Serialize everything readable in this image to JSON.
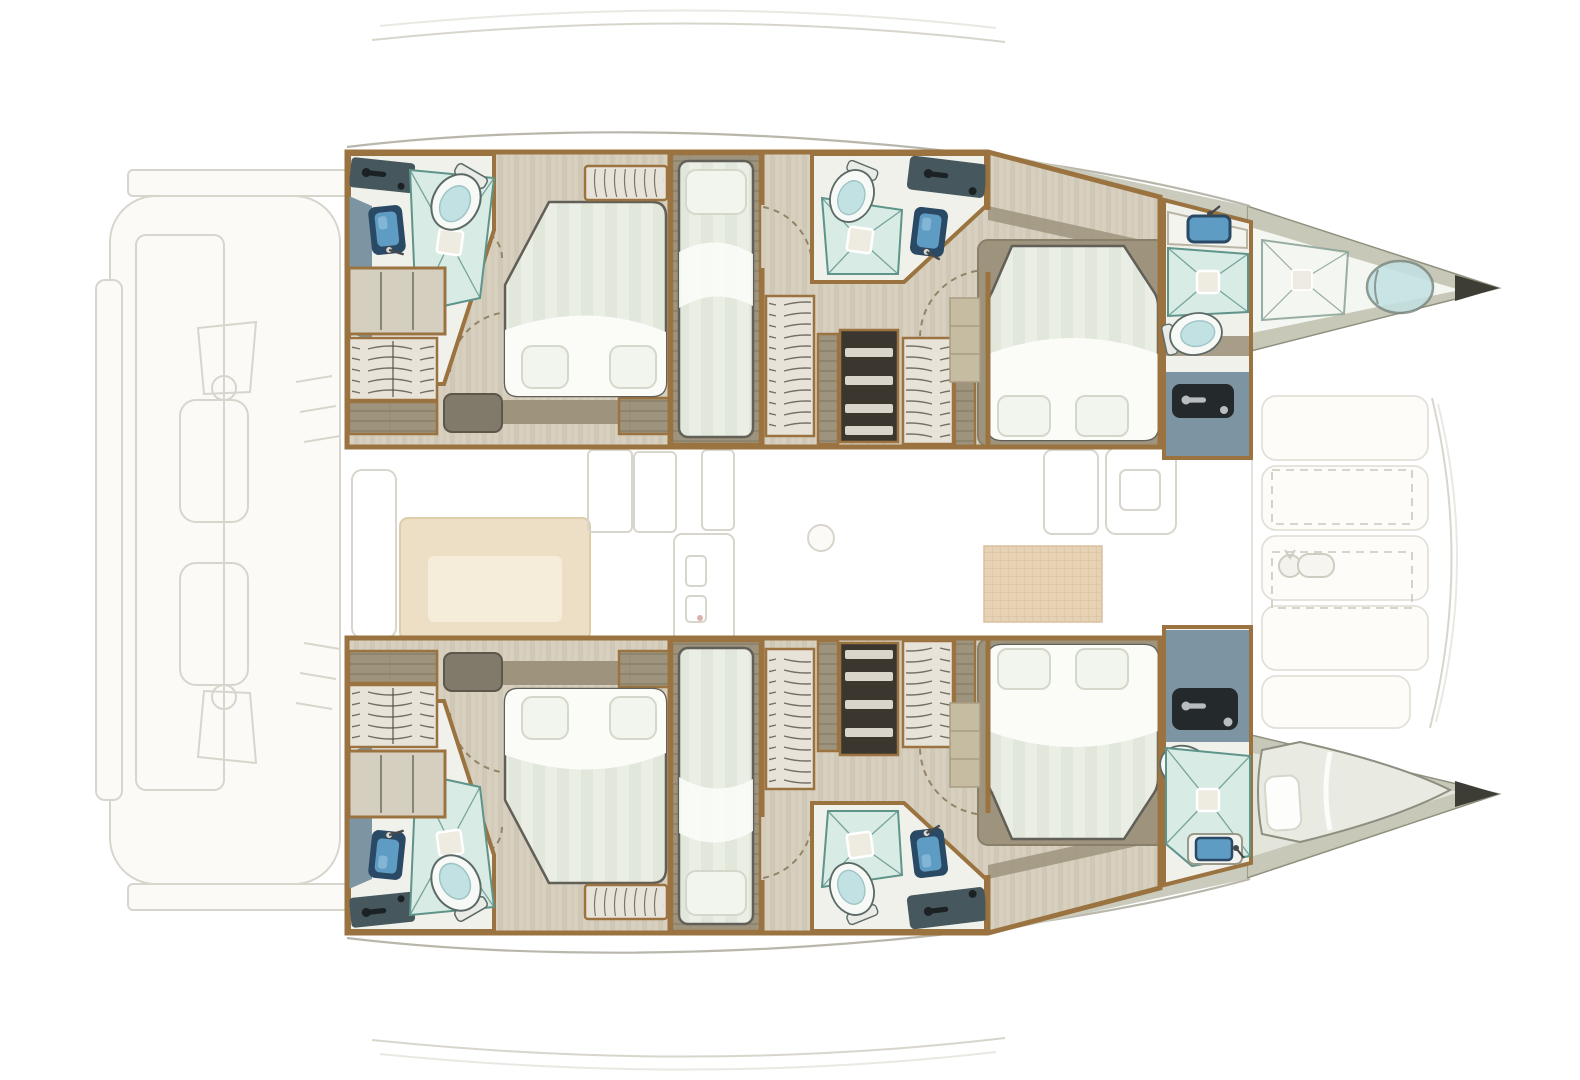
{
  "image": {
    "title": "Catamaran layout floor plan",
    "subject": "Top-down deck plan of a sailing catamaran: five-cabin interior layout, bow to the right, stern to the left; hull accommodations rendered in colour, saloon, cockpit and foredeck ghosted in pale outline",
    "text_labels": []
  },
  "palette": {
    "bg": "#ffffff",
    "ghost_stroke": "#d8d5cc",
    "ghost_fill": "#fbfaf6",
    "hull_outline": "#b9b6ab",
    "deck_band": "#c8c8b9",
    "deck_band_edge": "#90907f",
    "bow_tip": "#3d3d36",
    "floor_wood": "#d8d0bf",
    "floor_stripe": "#cbc3b0",
    "trim_wood": "#9a7340",
    "wall_white": "#f1f1ec",
    "bed_base": "#ebeee5",
    "bed_stripe": "#dfe4d8",
    "bed_sheet": "#fbfcf8",
    "pillow": "#f2f4ee",
    "pillow_shadow": "#d4d8cb",
    "bed_outline": "#615f57",
    "frame_taupe": "#9e947e",
    "platform_taupe": "#c6bca2",
    "cabinet_light": "#d5cfc0",
    "cabinet_dark": "#3c372e",
    "shelf_light": "#e7e3d8",
    "tambour_line": "#4c483f",
    "shower_fill": "#d8ebe4",
    "shower_line": "#5e948a",
    "drain_fill": "#eeebe0",
    "toilet_body": "#f7f9f6",
    "toilet_seat": "#c2e1e3",
    "toilet_line": "#5c6a66",
    "sink_blue": "#5f9cc4",
    "sink_light": "#8abad7",
    "sink_frame": "#2a4964",
    "counter_slate": "#46575d",
    "counter_dark": "#24292c",
    "faucet_dark": "#1c2124",
    "faucet_light": "#b9bdbf",
    "slate_floor": "#7d95a3",
    "saloon_tan": "#ecdfc5",
    "saloon_tan_light": "#f5edd9",
    "mat_tan": "#e7d2b4",
    "mat_line": "#d7bf9f",
    "door_dash": "#8b7c5d",
    "bow_interior_top": "#f4f6f1",
    "bow_interior_btm": "#e3e5da",
    "berth_fill": "#e9ebe2"
  },
  "vessel": {
    "type": "sailing catamaran",
    "orientation": {
      "bow": "right",
      "stern": "left"
    },
    "hulls": [
      {
        "id": "port-hull",
        "position": "top",
        "rooms": [
          {
            "name": "aft-head",
            "fixtures": [
              "shower",
              "toilet",
              "washbasin",
              "vanity-counter",
              "wet-floor"
            ]
          },
          {
            "name": "aft-double-cabin",
            "fixtures": [
              "double-bed",
              "two-pillows",
              "wardrobe-shelves",
              "tambour-cabinet",
              "storage-bench",
              "hatch-blind"
            ]
          },
          {
            "name": "single-berth-cabin",
            "fixtures": [
              "single-bed",
              "pillow"
            ]
          },
          {
            "name": "mid-head",
            "fixtures": [
              "shower",
              "toilet",
              "washbasin",
              "vanity-counter"
            ]
          },
          {
            "name": "companionway",
            "fixtures": [
              "tambour-cabinet",
              "open-shelf-unit",
              "tambour-cabinet"
            ]
          },
          {
            "name": "forward-island-cabin",
            "fixtures": [
              "island-double-bed",
              "two-pillows",
              "step-platform"
            ]
          },
          {
            "name": "forward-head",
            "fixtures": [
              "washbasin",
              "shower",
              "toilet",
              "vanity-counter",
              "wet-floor"
            ]
          },
          {
            "name": "forepeak",
            "fixtures": [
              "shower",
              "toilet"
            ]
          }
        ]
      },
      {
        "id": "starboard-hull",
        "position": "bottom",
        "rooms": [
          {
            "name": "aft-head",
            "fixtures": [
              "shower",
              "toilet",
              "washbasin",
              "vanity-counter",
              "wet-floor"
            ]
          },
          {
            "name": "aft-double-cabin",
            "fixtures": [
              "double-bed",
              "two-pillows",
              "wardrobe-shelves",
              "tambour-cabinet",
              "storage-bench",
              "hatch-blind"
            ]
          },
          {
            "name": "single-berth-cabin",
            "fixtures": [
              "single-bed",
              "pillow"
            ]
          },
          {
            "name": "mid-head",
            "fixtures": [
              "shower",
              "toilet",
              "washbasin",
              "vanity-counter"
            ]
          },
          {
            "name": "companionway",
            "fixtures": [
              "tambour-cabinet",
              "open-shelf-unit",
              "tambour-cabinet"
            ]
          },
          {
            "name": "forward-island-cabin",
            "fixtures": [
              "island-double-bed",
              "two-pillows",
              "step-platform"
            ]
          },
          {
            "name": "forward-head",
            "fixtures": [
              "vanity-counter",
              "toilet",
              "shower",
              "washbasin",
              "wet-floor"
            ]
          },
          {
            "name": "forepeak",
            "fixtures": [
              "crew-berth",
              "pillow"
            ]
          }
        ]
      }
    ],
    "ghosted_areas": [
      {
        "name": "aft-cockpit-and-transoms",
        "items": [
          "crossbeam",
          "swim-platform",
          "davit-pads",
          "engine-vents"
        ]
      },
      {
        "name": "saloon",
        "items": [
          "sofa",
          "chaise",
          "galley-units",
          "fridge",
          "table-leg",
          "woven-floor-mat",
          "nav-console",
          "companionway-steps"
        ]
      },
      {
        "name": "foredeck",
        "items": [
          "deck-lockers",
          "hatch",
          "hatch",
          "windlass",
          "bow-crossbeam-lines"
        ]
      },
      {
        "name": "coachroof-arcs",
        "items": [
          "hardtop-edge-top",
          "hardtop-edge-bottom"
        ]
      }
    ],
    "fixture_totals": {
      "double_beds": 4,
      "single_berths": 2,
      "crew_berths": 1,
      "showers": 7,
      "toilets": 7,
      "washbasins": 6
    }
  }
}
